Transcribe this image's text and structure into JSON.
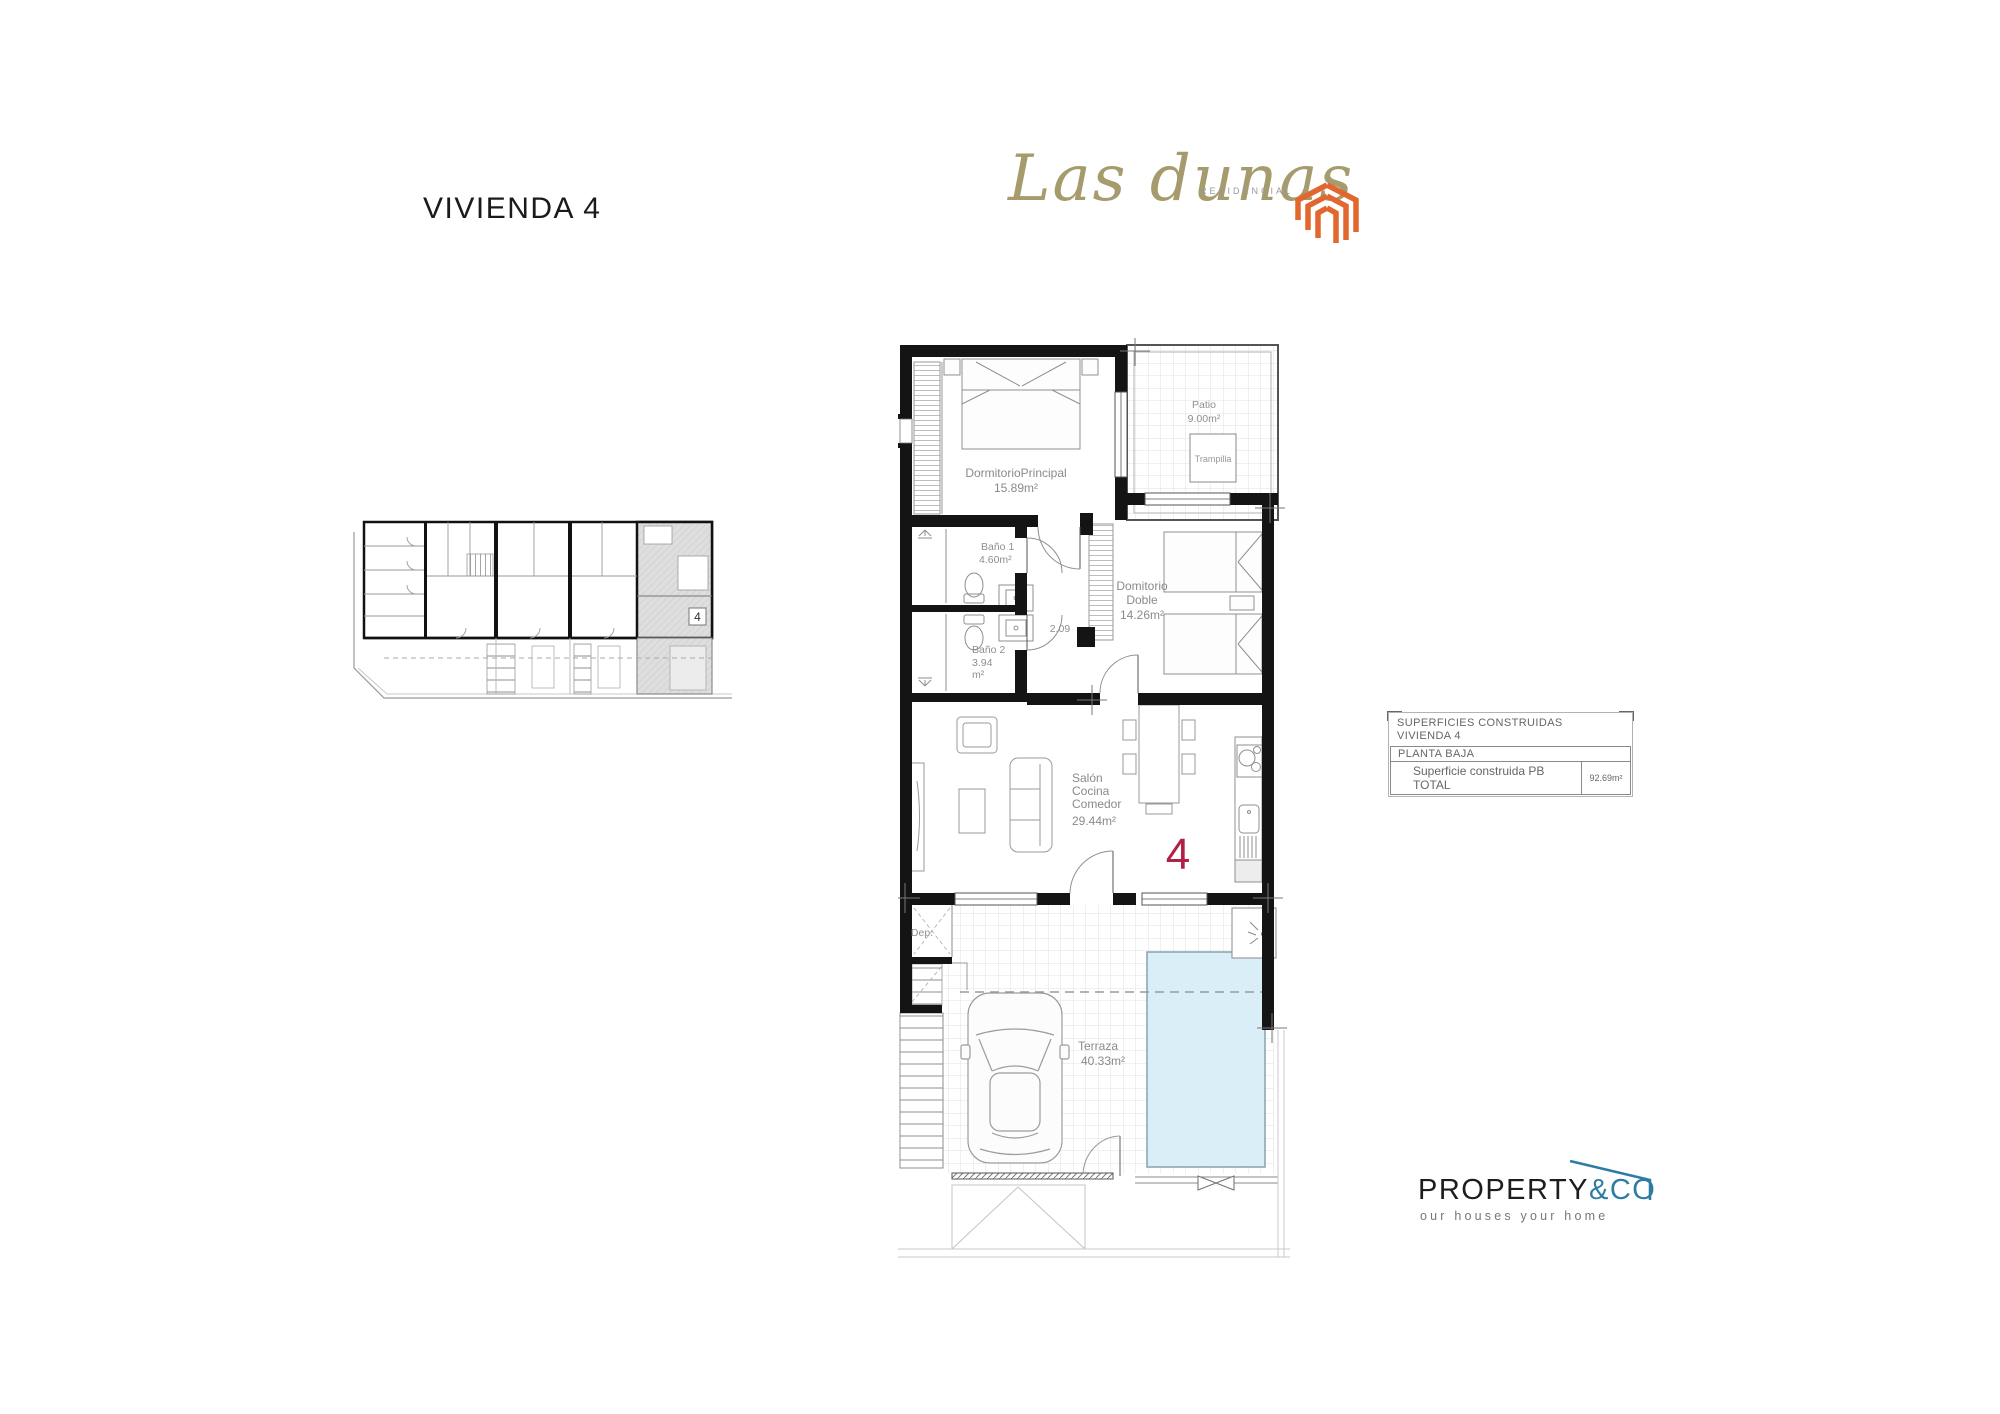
{
  "page_title": "VIVIENDA 4",
  "brand": {
    "name": "Las dunas",
    "subtitle": "RESIDENCIAL",
    "gold_color": "#a59b6d",
    "icon_color": "#e2672e"
  },
  "site_plan": {
    "unit_badge": "4"
  },
  "plan": {
    "unit_number": "4",
    "unit_number_color": "#b32045",
    "corridor_dim": "2.09",
    "pool_color": "#daeef8",
    "rooms": {
      "dormitorio_principal": {
        "name": "DormitorioPrincipal",
        "area": "15.89m²"
      },
      "patio": {
        "name": "Patio",
        "area": "9.00m²"
      },
      "trampilla": {
        "name": "Trampilla"
      },
      "bano1": {
        "name": "Baño 1",
        "area": "4.60m²"
      },
      "bano2": {
        "name": "Baño 2",
        "area_line1": "3.94",
        "area_line2": "m²"
      },
      "dormitorio_doble": {
        "name_line1": "Domitorio",
        "name_line2": "Doble",
        "area": "14.26m²"
      },
      "salon": {
        "name_line1": "Salón",
        "name_line2": "Cocina",
        "name_line3": "Comedor",
        "area": "29.44m²"
      },
      "terraza": {
        "name": "Terraza",
        "area": "40.33m²"
      },
      "dep": {
        "name": "Dep."
      }
    }
  },
  "areas_table": {
    "title_line1": "SUPERFICIES CONSTRUIDAS",
    "title_line2": "VIVIENDA 4",
    "section_label": "PLANTA BAJA",
    "total_label": "Superficie construida PB TOTAL",
    "total_value": "92.69m²"
  },
  "agency": {
    "name_black": "PROPERTY",
    "name_accent": "&CO",
    "tagline": "our houses your home",
    "accent_color": "#2d7ca3"
  }
}
